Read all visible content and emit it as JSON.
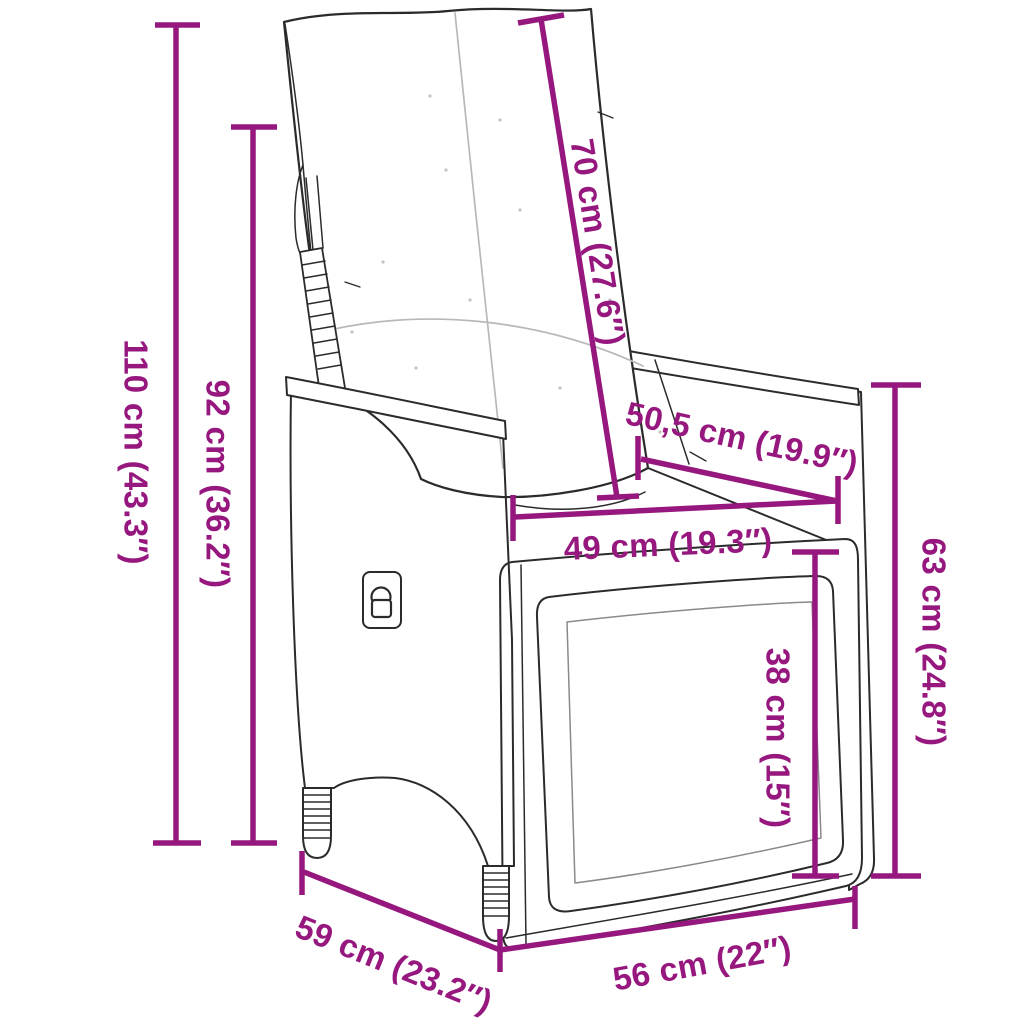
{
  "page": {
    "background": "#ffffff",
    "description": "Line-art dimension diagram of a reclining poly-rattan garden chair with back and seat cushions"
  },
  "colors": {
    "dimension_magenta": "#96187E",
    "line_art": "#2b2b2b",
    "seam_gray": "#b8b8b8"
  },
  "measurements": [
    {
      "id": "total-height",
      "label": "110 cm (43.3″)"
    },
    {
      "id": "backrest-height",
      "label": "92 cm (36.2″)"
    },
    {
      "id": "backrest-length",
      "label": "70 cm (27.6″)"
    },
    {
      "id": "armrest-depth",
      "label": "50,5 cm (19.9″)"
    },
    {
      "id": "seat-width-back",
      "label": "49 cm (19.3″)"
    },
    {
      "id": "armrest-height",
      "label": "63 cm (24.8″)"
    },
    {
      "id": "seat-height",
      "label": "38 cm (15″)"
    },
    {
      "id": "base-depth",
      "label": "59 cm (23.2″)"
    },
    {
      "id": "seat-width-front",
      "label": "56 cm (22″)"
    }
  ]
}
